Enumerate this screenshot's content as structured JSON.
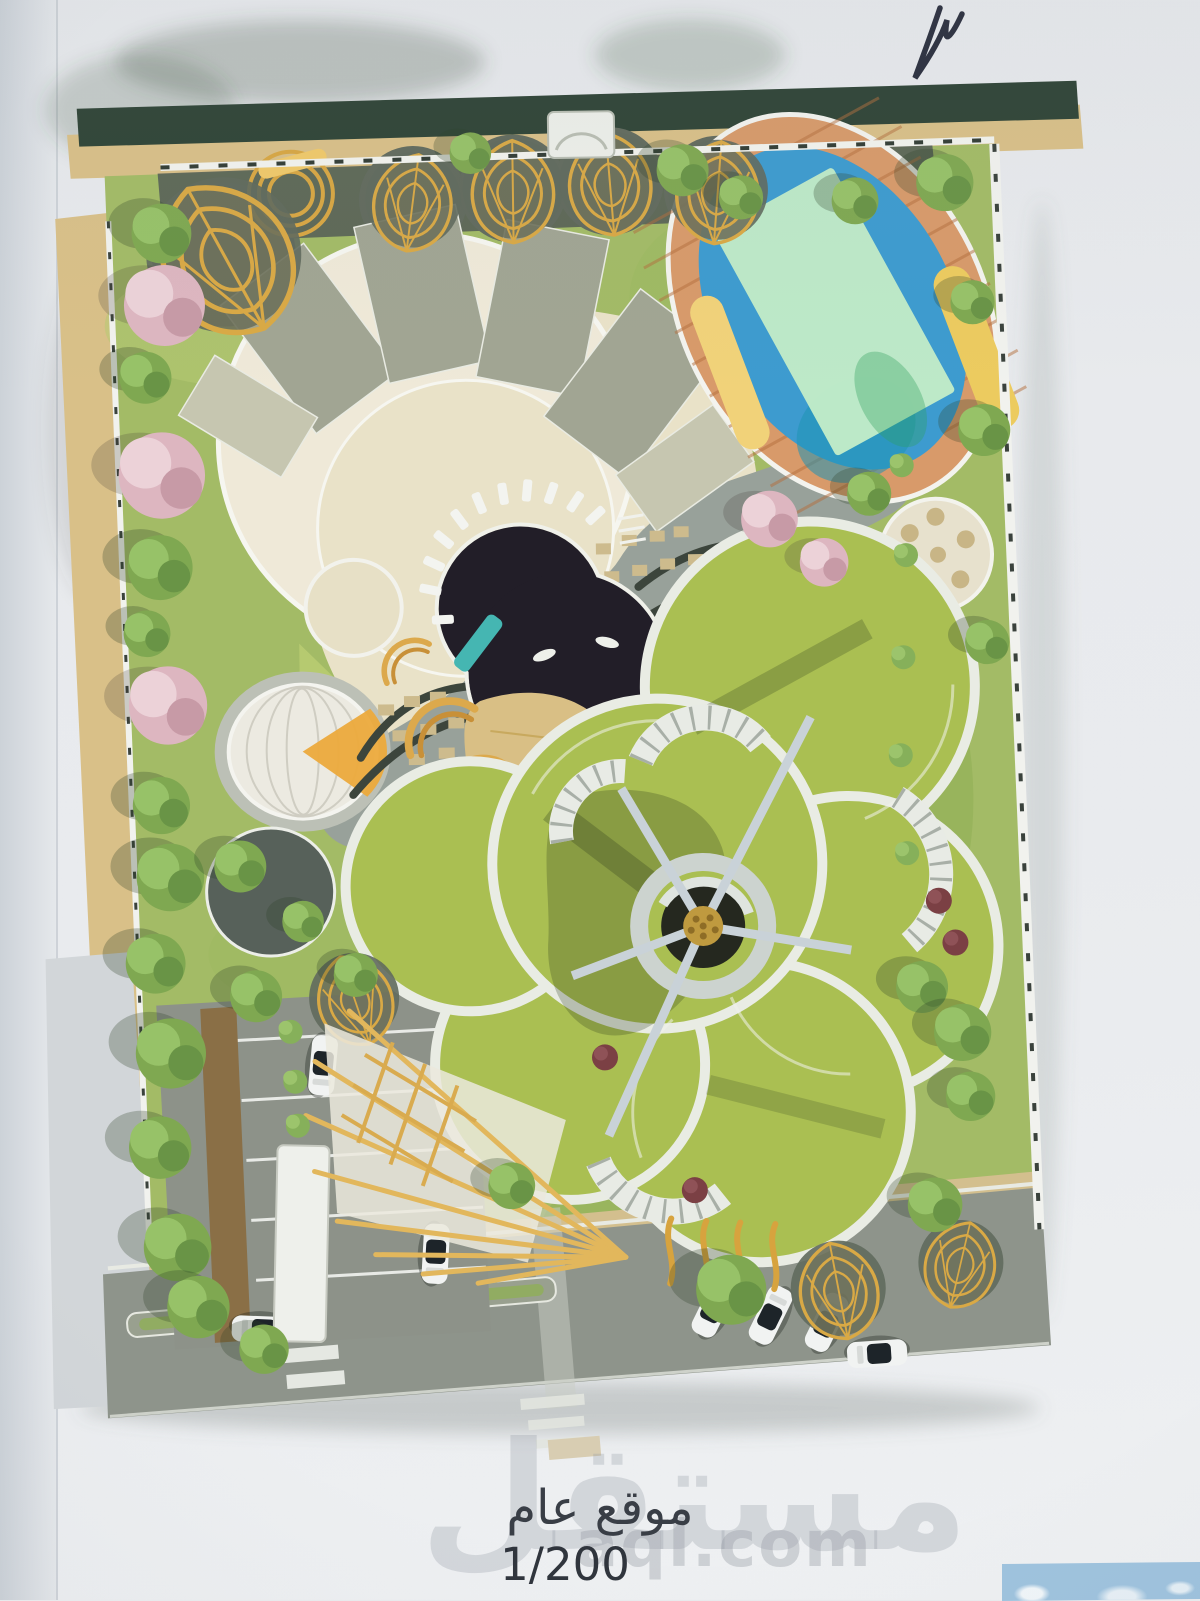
{
  "document": {
    "caption": {
      "title": "موقع عام",
      "scale": "1/200"
    },
    "watermark": {
      "arabic": "مستقل",
      "latin": "aql.com"
    }
  },
  "palette": {
    "paper": "#e9ebee",
    "page_edge": "#ccd2d8",
    "wall_tan": "#d9c088",
    "hedge_dark_green": "#2f4436",
    "lawn_green": "#a3bb66",
    "petal_green": "#aabf52",
    "stone_paving": "#98a19a",
    "plaza_beige": "#e9e2c8",
    "pool_water": "#3d9bcf",
    "pool_deck_wood": "#d89a6a",
    "pool_shallow": "#c3ecc8",
    "canopy_yellow": "#f0d078",
    "pond_dark": "#221e28",
    "gold_structures": "#d9a945",
    "building_cream": "#efe9d8",
    "roof_olive": "#a1a593",
    "tree_green": "#7fa851",
    "tree_pink": "#ddb6c0",
    "road_asphalt": "#8e948b",
    "car_white": "#f1f3f2",
    "sky_fragment": "#9fc3de",
    "pen_ink": "#2b2f3e"
  },
  "features": [
    "perimeter-wall",
    "hedge-row",
    "gold-leaf-pavilions",
    "crescent-building",
    "swimming-pool",
    "wood-deck",
    "dark-pond",
    "lounger-ring",
    "dome-pavilion",
    "playground-arches",
    "sand-pit",
    "flower-petal-building",
    "central-sculpture",
    "fan-pergola",
    "parking-lot",
    "access-road",
    "crosswalk",
    "median-island",
    "entrance-canopy",
    "street-cars",
    "perimeter-trees",
    "pen-mark",
    "photo-fragment"
  ]
}
